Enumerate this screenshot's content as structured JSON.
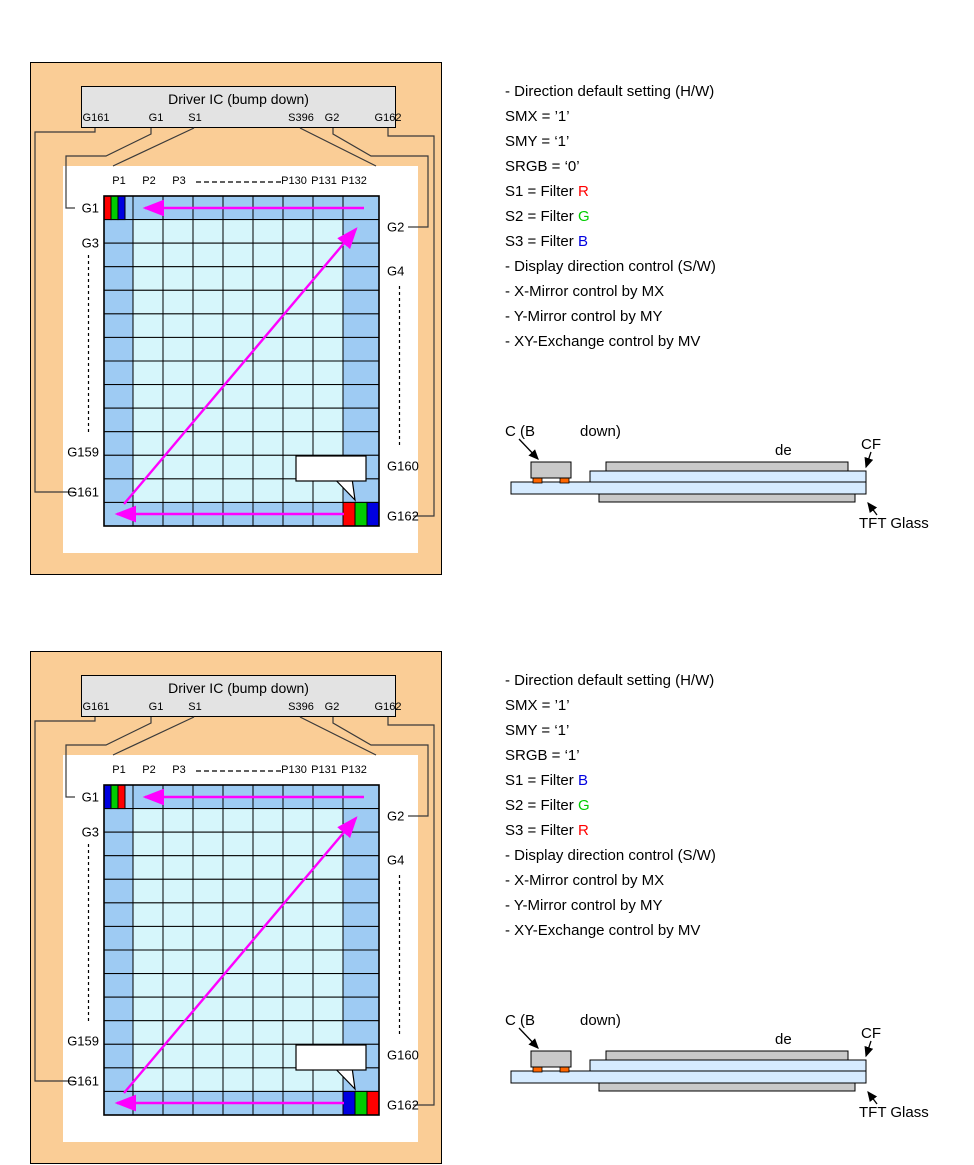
{
  "colors": {
    "panel_bg": "#FACD96",
    "ring": "#9ECBF3",
    "cell": "#D6F6FB",
    "arrow": "#FF00FF",
    "glass": "#D6EBFF",
    "bar": "#C9C9C9",
    "bump": "#FF6600",
    "driver_box": "#E3E3E3",
    "wire": "#3a3a3a"
  },
  "filter_colors": {
    "R": "#FF0000",
    "G": "#00CC00",
    "B": "#0000E0"
  },
  "sections": [
    {
      "panel": {
        "driver_title": "Driver IC (bump down)",
        "pins": [
          "G161",
          "G1",
          "S1",
          "S396",
          "G2",
          "G162"
        ],
        "col_labels": [
          "P1",
          "P2",
          "P3",
          "P130",
          "P131",
          "P132"
        ],
        "left_labels": [
          "G1",
          "G3",
          "G159",
          "G161"
        ],
        "right_labels": [
          "G2",
          "G4",
          "G160",
          "G162"
        ],
        "filter_order": [
          "R",
          "G",
          "B"
        ]
      },
      "settings": {
        "heading": "- Direction default setting (H/W)",
        "smx": "SMX = ’1’",
        "smy": "SMY = ‘1’",
        "srgb": "SRGB = ‘0’",
        "filters": [
          {
            "prefix": "S1 = Filter ",
            "filter": "R"
          },
          {
            "prefix": "S2 = Filter ",
            "filter": "G"
          },
          {
            "prefix": "S3 = Filter ",
            "filter": "B"
          }
        ],
        "sw_heading": "- Display direction control (S/W)",
        "controls": [
          "- X-Mirror control by MX",
          "- Y-Mirror control by MY",
          "- XY-Exchange control by MV"
        ]
      },
      "cross_section": {
        "chip_a": "C (B",
        "chip_b": "down)",
        "de": "de",
        "cf": "CF",
        "tft": "TFT Glass"
      }
    },
    {
      "panel": {
        "driver_title": "Driver IC (bump down)",
        "pins": [
          "G161",
          "G1",
          "S1",
          "S396",
          "G2",
          "G162"
        ],
        "col_labels": [
          "P1",
          "P2",
          "P3",
          "P130",
          "P131",
          "P132"
        ],
        "left_labels": [
          "G1",
          "G3",
          "G159",
          "G161"
        ],
        "right_labels": [
          "G2",
          "G4",
          "G160",
          "G162"
        ],
        "filter_order": [
          "B",
          "G",
          "R"
        ]
      },
      "settings": {
        "heading": "- Direction default setting (H/W)",
        "smx": "SMX = ’1’",
        "smy": "SMY = ‘1’",
        "srgb": "SRGB = ‘1’",
        "filters": [
          {
            "prefix": "S1 = Filter ",
            "filter": "B"
          },
          {
            "prefix": "S2 = Filter ",
            "filter": "G"
          },
          {
            "prefix": "S3 = Filter ",
            "filter": "R"
          }
        ],
        "sw_heading": "- Display direction control (S/W)",
        "controls": [
          "- X-Mirror control by MX",
          "- Y-Mirror control by MY",
          "- XY-Exchange control by MV"
        ]
      },
      "cross_section": {
        "chip_a": "C (B",
        "chip_b": "down)",
        "de": "de",
        "cf": "CF",
        "tft": "TFT Glass"
      }
    }
  ]
}
